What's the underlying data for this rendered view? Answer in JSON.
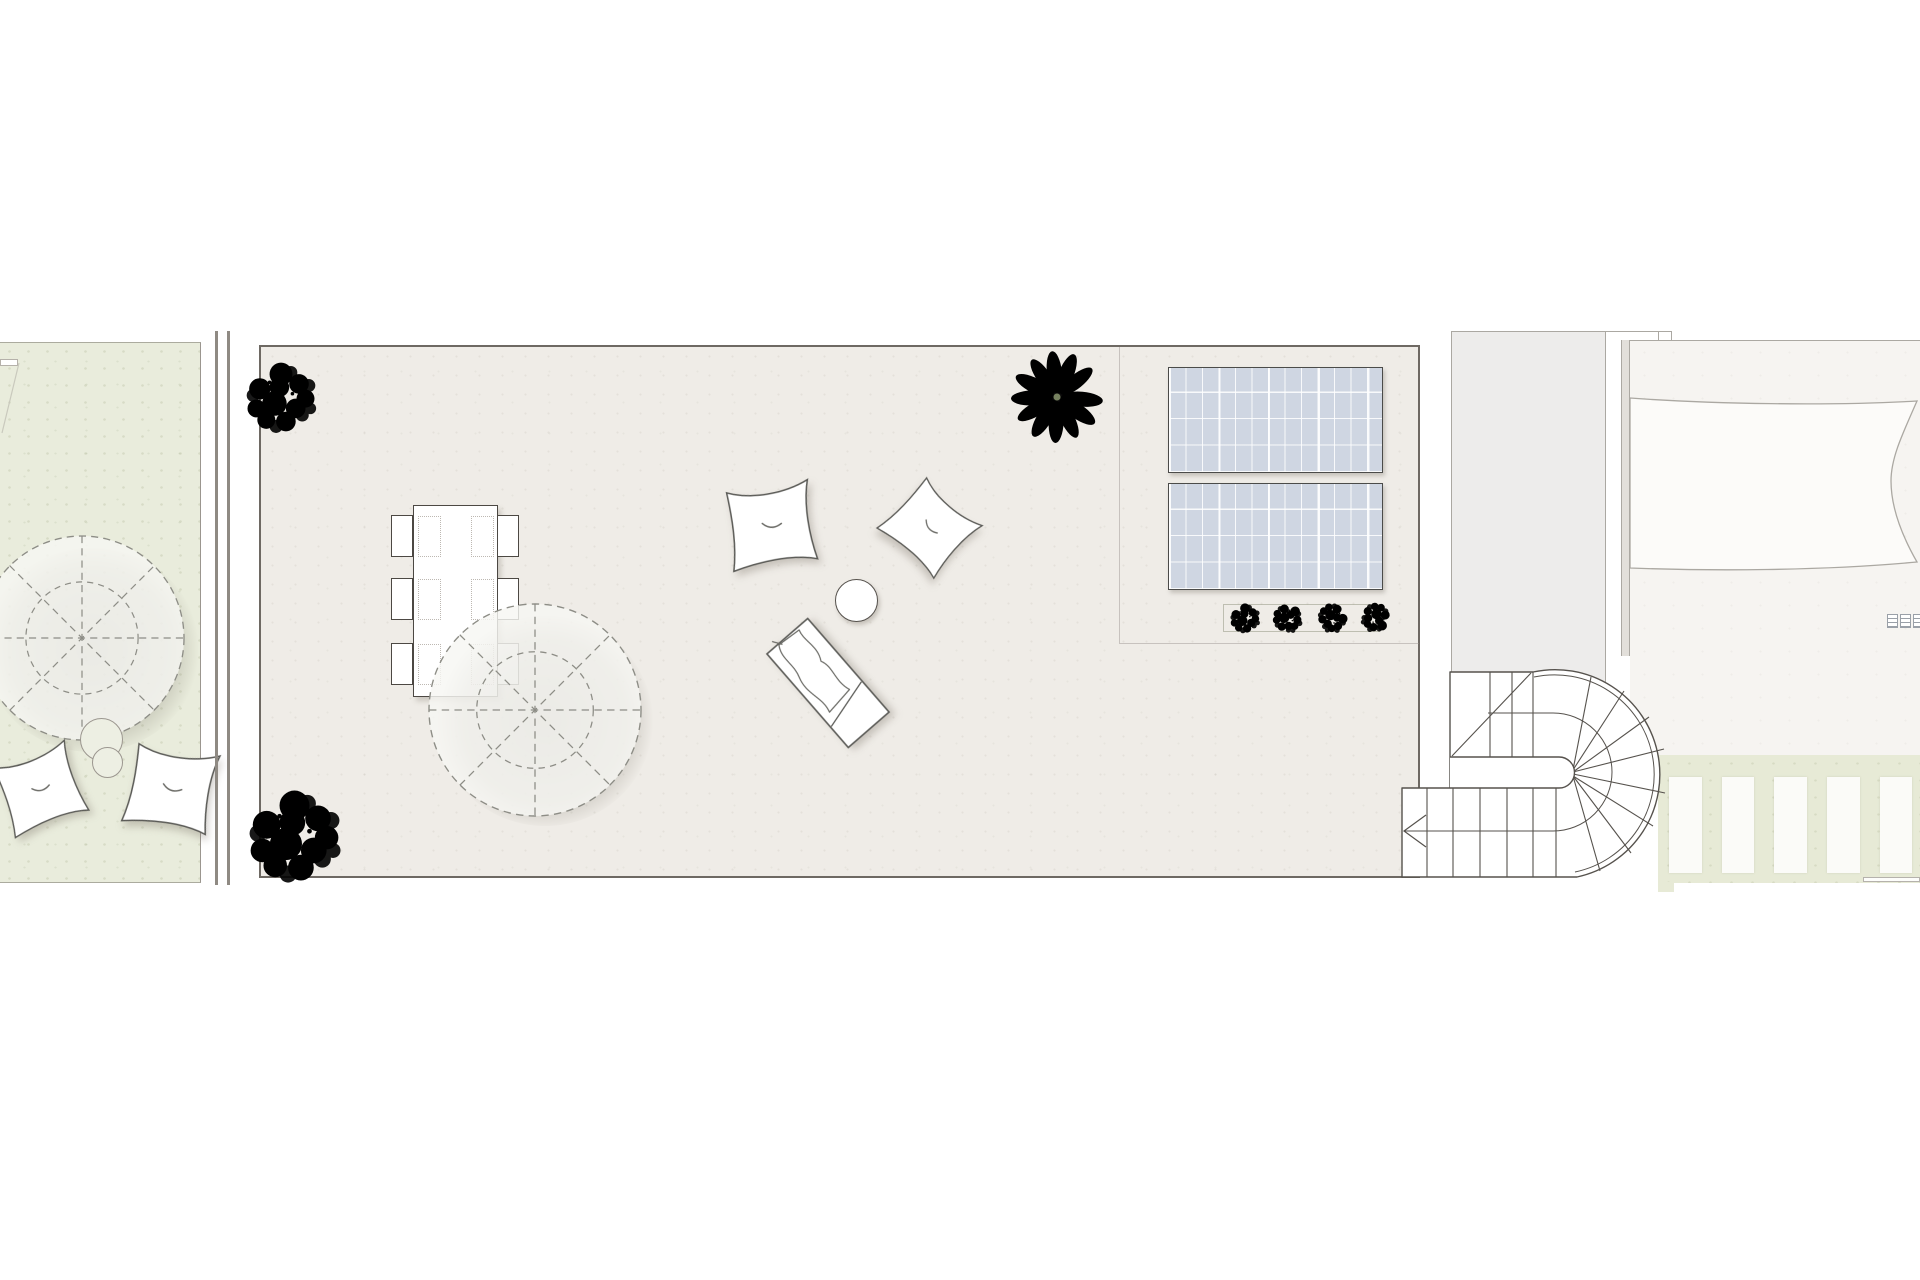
{
  "meta": {
    "title": "Roof terrace floor plan",
    "style": "architectural plan drawing, top view, no text labels visible",
    "visible_text": "none"
  },
  "palette": {
    "terrace-fill": "#efece7",
    "terrace-border": "#6e6963",
    "garden-fill": "#e9ecdc",
    "garden-border": "#abab9e",
    "green-strip-fill": "#e7ead6",
    "hall-fill": "#edeceb",
    "roof-fill": "#f6f4f1",
    "roof-inner-fill": "#fcfbf9",
    "roof-line": "#aba8a2",
    "wall-line": "#8f8a83",
    "line-dark": "#56524d",
    "line-mid": "#9b968f",
    "panel-fill": "#cfd6e2",
    "panel-border": "#4b4b49",
    "plant-sage-1": "#b7c5a9",
    "plant-sage-2": "#a6b897",
    "plant-sage-3": "#c8d2bc",
    "plant-stem": "#76815f",
    "shrub-1": "#8abf72",
    "shrub-2": "#79b161",
    "shrub-3": "#9ccb86",
    "shrub-dark": "#5f9a4a",
    "hedge-1": "#a3af89",
    "hedge-2": "#91a077",
    "hedge-3": "#b3bd9b",
    "parasol-fill": "#f6f6f3",
    "dash-line": "#8d8d86"
  },
  "areas": {
    "garden_left": {
      "label": "neighbouring roof garden (partial)",
      "features": [
        "parasol shown as dashed circle with 8 spokes",
        "two overlapping round side tables",
        "two lounge cushions"
      ]
    },
    "party_wall": {
      "label": "double party-wall lines between garden and terrace"
    },
    "terrace": {
      "label": "main roof terrace",
      "features": [
        "dining table with six chairs",
        "large parasol dashed circle",
        "two lounge cushions",
        "round side table",
        "sun lounger with towel",
        "three plants",
        "two solar panels",
        "hedge planter"
      ]
    },
    "stair_hall": {
      "label": "stair hall strip"
    },
    "stairs": {
      "label": "U-shaped stair with curved winders",
      "upper_straight_treads": 3,
      "lower_straight_treads": 5,
      "winder_treads": 8,
      "has_direction_arrow": true,
      "has_walking_line": true
    },
    "roof_right": {
      "label": "adjacent roof with curved skylight outline",
      "grille_count": 3
    },
    "pergola": {
      "label": "pergola slats over planting strip",
      "slat_count": 5
    }
  },
  "dining": {
    "chair_count": 6,
    "placemat_count": 6,
    "rows": 3,
    "cols": 2
  },
  "solar": {
    "panel_count": 2,
    "grid_columns": 13,
    "grid_rows": 4
  },
  "hedge": {
    "shrub_count": 4
  },
  "plants": {
    "sage_leaf_plants": 1,
    "scribble_shrubs": 2
  },
  "parasols": {
    "count": 2,
    "spokes": 8
  }
}
